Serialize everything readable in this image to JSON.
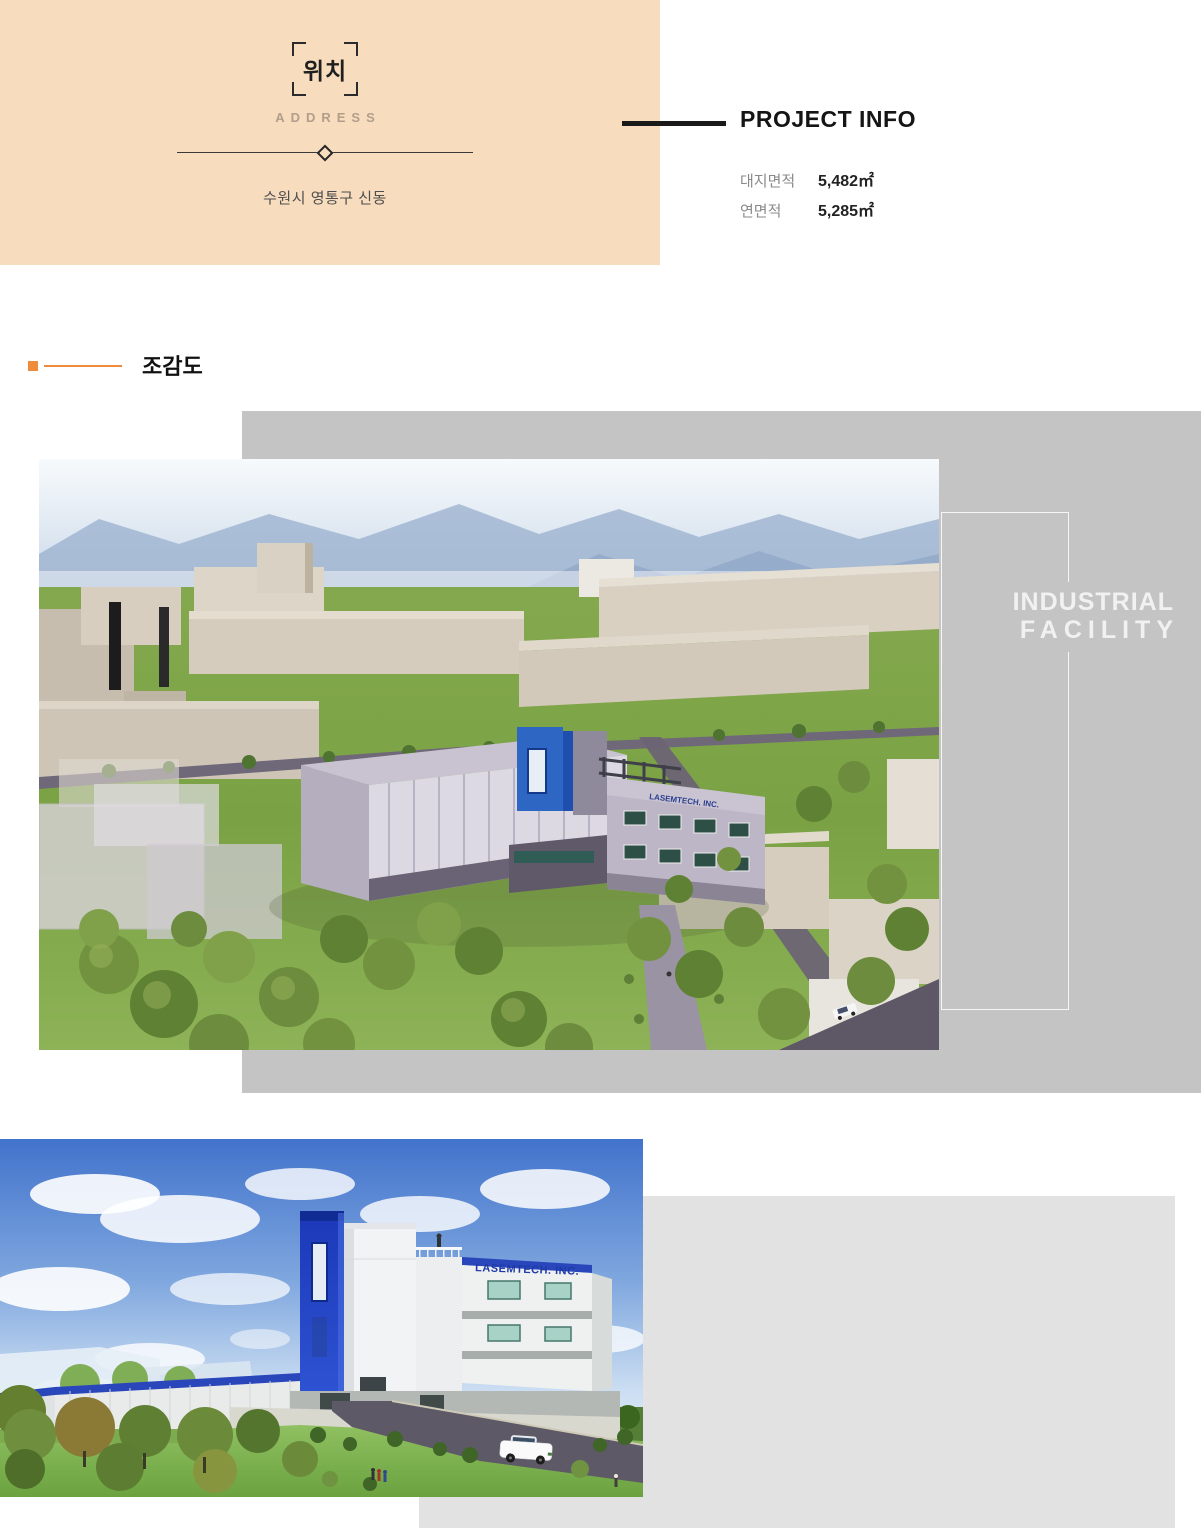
{
  "location_card": {
    "title": "위치",
    "subtitle": "ADDRESS",
    "address": "수원시 영통구 신동"
  },
  "project_info": {
    "title": "PROJECT INFO",
    "rows": [
      {
        "label": "대지면적",
        "value": "5,482㎡"
      },
      {
        "label": "연면적",
        "value": "5,285㎡"
      }
    ]
  },
  "sections": {
    "aerial_view": "조감도"
  },
  "overlay": {
    "line1": "INDUSTRIAL",
    "line2": "FACILITY"
  },
  "renderings": {
    "aerial_sign": "LASEMTECH. INC.",
    "street_sign": "LASEMTECH. INC."
  },
  "colors": {
    "peach": "#f8dcbe",
    "accent_orange": "#ee8c3c",
    "panel_gray": "#c4c4c4",
    "panel_light_gray": "#e2e2e2",
    "ink": "#1a1a1a",
    "muted_label": "#8a8a8a",
    "facility_text": "#f1f1f1",
    "signage_blue": "#1f3aa8"
  }
}
